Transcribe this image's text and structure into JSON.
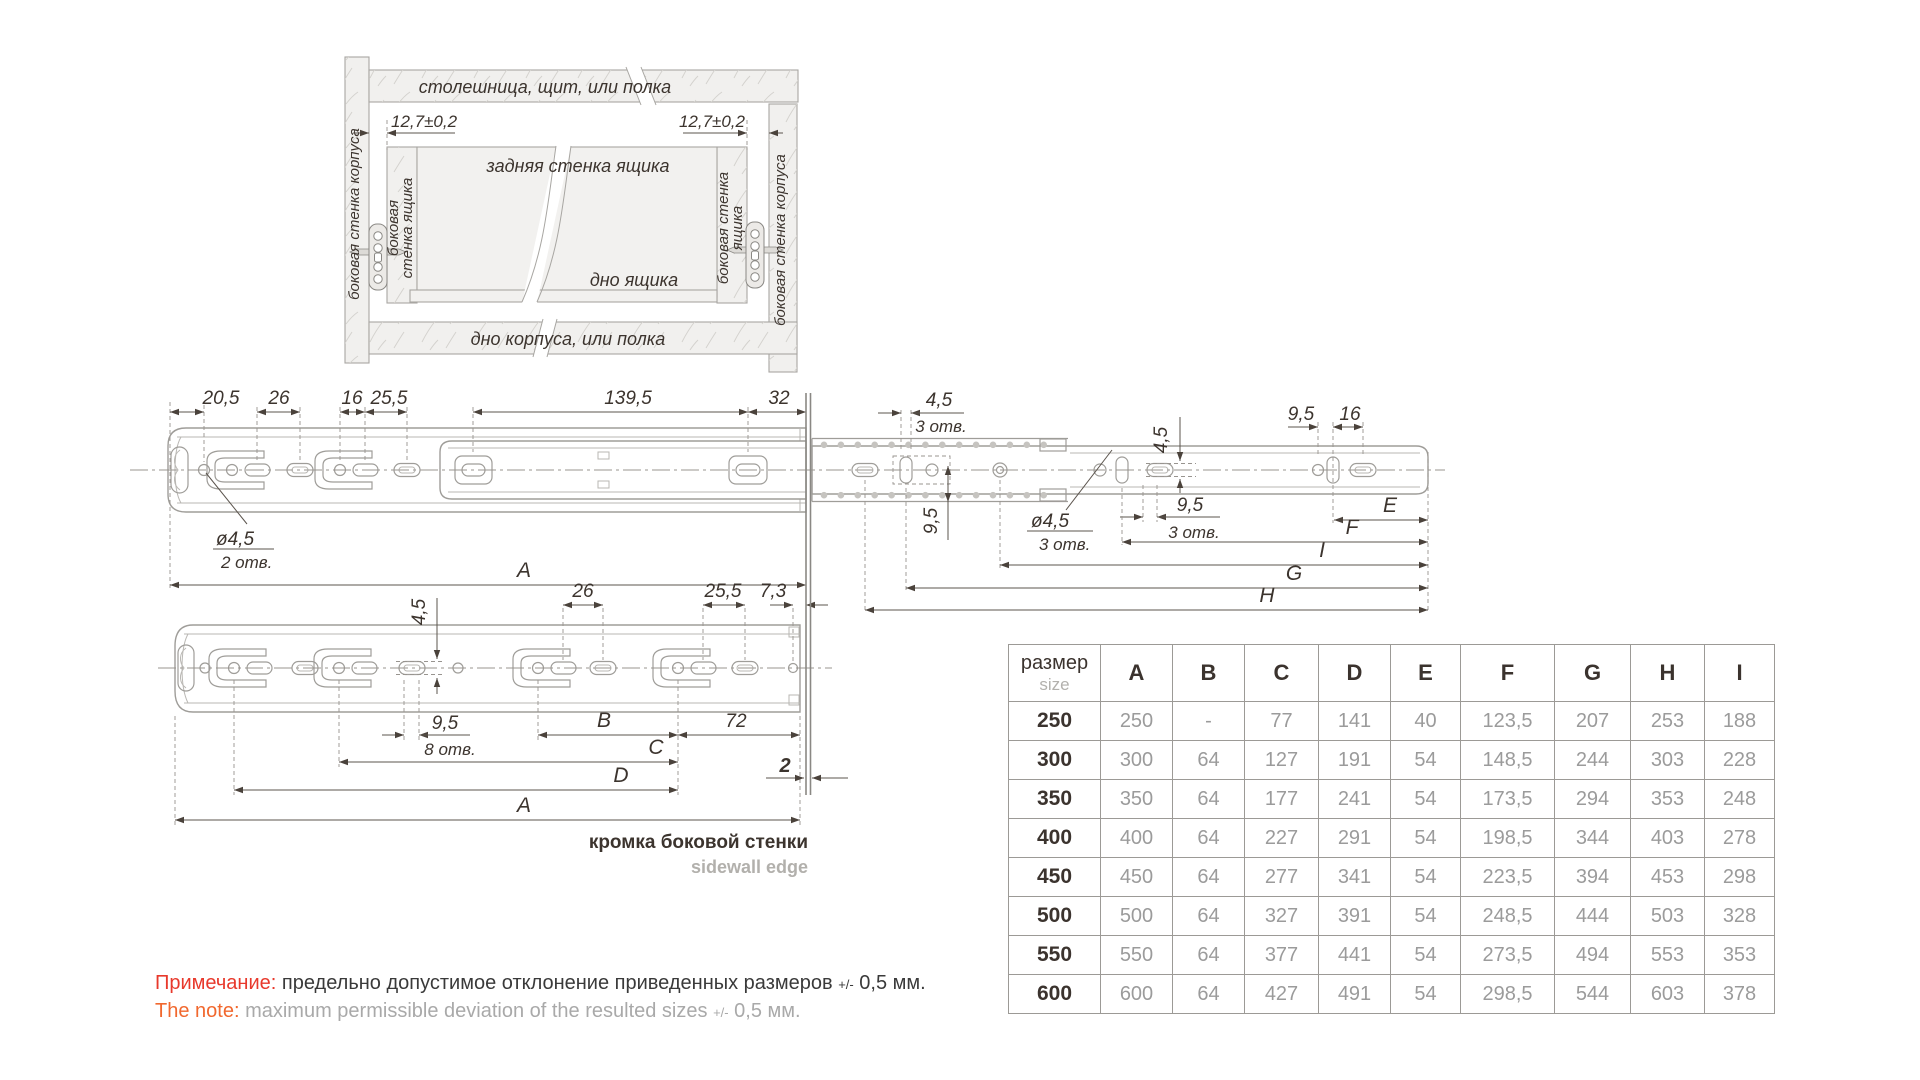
{
  "installation_view": {
    "top_panel": "столешница, щит, или полка",
    "cabinet_side_left": "боковая стенка корпуса",
    "cabinet_side_right": "боковая стенка корпуса",
    "drawer_side_left_l1": "боковая",
    "drawer_side_left_l2": "стенка ящика",
    "drawer_side_right_l1": "боковая стенка",
    "drawer_side_right_l2": "ящика",
    "drawer_back": "задняя стенка ящика",
    "drawer_bottom": "дно ящика",
    "cabinet_bottom": "дно корпуса, или полка",
    "offset_left": "12,7±0,2",
    "offset_right": "12,7±0,2"
  },
  "side_view": {
    "d20_5": "20,5",
    "d26": "26",
    "d16": "16",
    "d25_5": "25,5",
    "d139_5": "139,5",
    "d32": "32",
    "d4_5_top": "4,5",
    "d4_5_top_holes": "3 отв.",
    "d4_5_vert": "4,5",
    "d9_5_tr": "9,5",
    "d16_tr": "16",
    "dia4_5_l": "ø4,5",
    "dia4_5_l_holes": "2 отв.",
    "d9_5_mid": "9,5",
    "dia4_5_m": "ø4,5",
    "dia4_5_m_holes": "3 отв.",
    "d9_5_r": "9,5",
    "d9_5_r_holes": "3 отв.",
    "A": "A",
    "E": "E",
    "F": "F",
    "I": "I",
    "G": "G",
    "H": "H"
  },
  "mount_view": {
    "d4_5": "4,5",
    "d26": "26",
    "d25_5": "25,5",
    "d7_3": "7,3",
    "d9_5": "9,5",
    "d9_5_holes": "8 отв.",
    "B": "B",
    "d72": "72",
    "C": "C",
    "D": "D",
    "A": "A",
    "d2": "2",
    "edge_ru": "кромка боковой стенки",
    "edge_en": "sidewall edge"
  },
  "table": {
    "size_ru": "размер",
    "size_en": "size",
    "columns": [
      "A",
      "B",
      "C",
      "D",
      "E",
      "F",
      "G",
      "H",
      "I"
    ],
    "rows": [
      {
        "size": "250",
        "values": [
          "250",
          "-",
          "77",
          "141",
          "40",
          "123,5",
          "207",
          "253",
          "188"
        ]
      },
      {
        "size": "300",
        "values": [
          "300",
          "64",
          "127",
          "191",
          "54",
          "148,5",
          "244",
          "303",
          "228"
        ]
      },
      {
        "size": "350",
        "values": [
          "350",
          "64",
          "177",
          "241",
          "54",
          "173,5",
          "294",
          "353",
          "248"
        ]
      },
      {
        "size": "400",
        "values": [
          "400",
          "64",
          "227",
          "291",
          "54",
          "198,5",
          "344",
          "403",
          "278"
        ]
      },
      {
        "size": "450",
        "values": [
          "450",
          "64",
          "277",
          "341",
          "54",
          "223,5",
          "394",
          "453",
          "298"
        ]
      },
      {
        "size": "500",
        "values": [
          "500",
          "64",
          "327",
          "391",
          "54",
          "248,5",
          "444",
          "503",
          "328"
        ]
      },
      {
        "size": "550",
        "values": [
          "550",
          "64",
          "377",
          "441",
          "54",
          "273,5",
          "494",
          "553",
          "353"
        ]
      },
      {
        "size": "600",
        "values": [
          "600",
          "64",
          "427",
          "491",
          "54",
          "298,5",
          "544",
          "603",
          "378"
        ]
      }
    ]
  },
  "note": {
    "ru_label": "Примечание:",
    "ru_text": "предельно допустимое отклонение приведенных размеров",
    "ru_tol": "+/-",
    "ru_value": "0,5 мм.",
    "en_label": "The note:",
    "en_text": "maximum permissible deviation of the resulted sizes",
    "en_tol": "+/-",
    "en_value": "0,5 мм."
  },
  "colors": {
    "note_ru_label": "#e8392c",
    "note_en_label": "#f1682e",
    "dim_text": "#3c342e",
    "drawing_line": "#9f9d99",
    "table_value": "#9b9b9b"
  }
}
